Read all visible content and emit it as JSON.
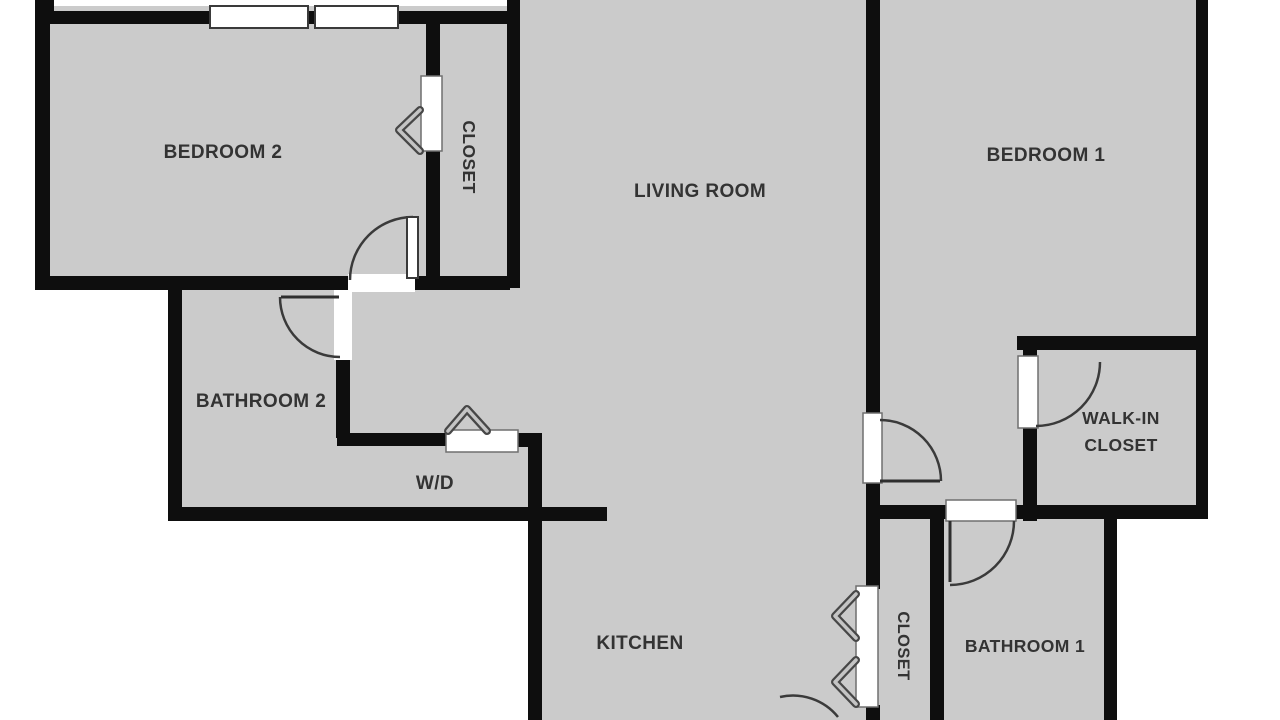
{
  "plan": {
    "type": "apartment-floor-plan",
    "colors": {
      "room_fill": "#cbcbcb",
      "wall": "#0e0e0e",
      "outside": "#ffffff",
      "label_text": "#333333",
      "symbol_stroke": "#3a3a3a"
    },
    "rooms": {
      "bedroom2": {
        "label": "BEDROOM 2"
      },
      "closet_top": {
        "label": "CLOSET",
        "orientation": "vertical"
      },
      "living_room": {
        "label": "LIVING ROOM"
      },
      "bedroom1": {
        "label": "BEDROOM 1"
      },
      "bathroom2": {
        "label": "BATHROOM 2"
      },
      "wd": {
        "label": "W/D"
      },
      "walk_in_closet": {
        "label_line1": "WALK-IN",
        "label_line2": "CLOSET"
      },
      "kitchen": {
        "label": "KITCHEN"
      },
      "closet_bottom": {
        "label": "CLOSET",
        "orientation": "vertical"
      },
      "bathroom1": {
        "label": "BATHROOM 1"
      }
    },
    "symbols": {
      "windows": 2,
      "swing_doors": 6,
      "bifold_doors": 3
    }
  }
}
